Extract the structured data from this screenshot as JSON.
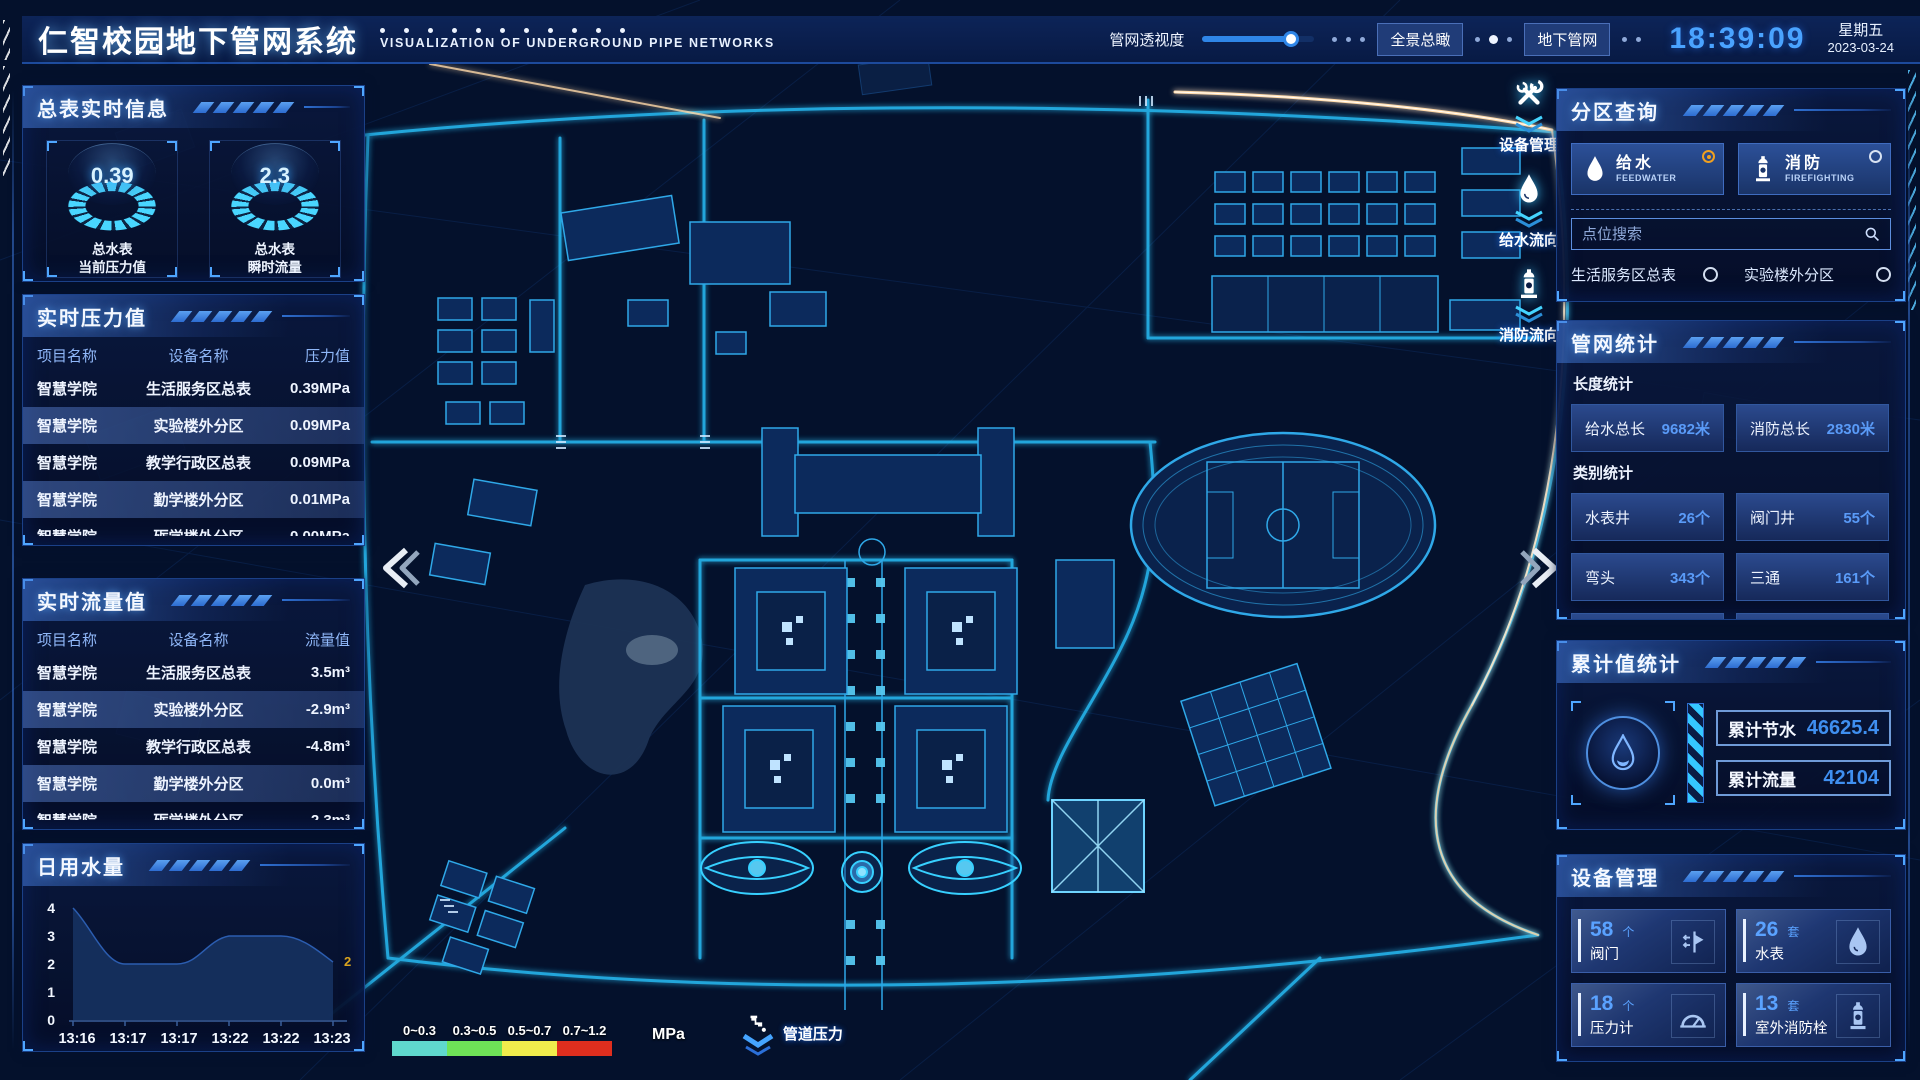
{
  "header": {
    "title": "仁智校园地下管网系统",
    "subtitle": "VISUALIZATION OF UNDERGROUND PIPE NETWORKS",
    "opacity_label": "管网透视度",
    "btn_overview": "全景总瞰",
    "btn_underground": "地下管网",
    "clock": "18:39:09",
    "weekday": "星期五",
    "date": "2023-03-24"
  },
  "meter_info": {
    "title": "总表实时信息",
    "gauges": [
      {
        "value": "0.39",
        "label1": "总水表",
        "label2": "当前压力值"
      },
      {
        "value": "2.3",
        "label1": "总水表",
        "label2": "瞬时流量"
      }
    ]
  },
  "pressure": {
    "title": "实时压力值",
    "headers": [
      "项目名称",
      "设备名称",
      "压力值"
    ],
    "rows": [
      {
        "project": "智慧学院",
        "device": "生活服务区总表",
        "value": "0.39MPa"
      },
      {
        "project": "智慧学院",
        "device": "实验楼外分区",
        "value": "0.09MPa"
      },
      {
        "project": "智慧学院",
        "device": "教学行政区总表",
        "value": "0.09MPa"
      },
      {
        "project": "智慧学院",
        "device": "勤学楼外分区",
        "value": "0.01MPa"
      },
      {
        "project": "智慧学院",
        "device": "砺学楼外分区",
        "value": "0.00MPa"
      }
    ]
  },
  "flow": {
    "title": "实时流量值",
    "headers": [
      "项目名称",
      "设备名称",
      "流量值"
    ],
    "rows": [
      {
        "project": "智慧学院",
        "device": "生活服务区总表",
        "value": "3.5m³"
      },
      {
        "project": "智慧学院",
        "device": "实验楼外分区",
        "value": "-2.9m³"
      },
      {
        "project": "智慧学院",
        "device": "教学行政区总表",
        "value": "-4.8m³"
      },
      {
        "project": "智慧学院",
        "device": "勤学楼外分区",
        "value": "0.0m³"
      },
      {
        "project": "智慧学院",
        "device": "砺学楼外分区",
        "value": "2.3m³"
      }
    ]
  },
  "chart_data": {
    "type": "area",
    "title": "日用水量",
    "x": [
      "13:16",
      "13:17",
      "13:17",
      "13:22",
      "13:22",
      "13:23"
    ],
    "values": [
      4,
      2,
      2,
      3,
      3,
      2
    ],
    "end_label": "2",
    "end_label_color": "#d9a41e",
    "yticks": [
      0,
      1,
      2,
      3,
      4
    ],
    "ylim": [
      0,
      4
    ],
    "grid": false,
    "area_color": "#16315f"
  },
  "zone": {
    "title": "分区查询",
    "feedwater": {
      "cn": "给水",
      "en": "FEEDWATER",
      "selected": true
    },
    "firefighting": {
      "cn": "消防",
      "en": "FIREFIGHTING",
      "selected": false
    },
    "search_placeholder": "点位搜索",
    "items": [
      "生活服务区总表",
      "实验楼外分区",
      "教学行政区总表",
      "勤学楼外分区",
      "砺学楼外分区",
      "宿舍区泵房"
    ]
  },
  "network_stats": {
    "title": "管网统计",
    "length_label": "长度统计",
    "category_label": "类别统计",
    "length_stats": [
      {
        "label": "给水总长",
        "value": "9682米"
      },
      {
        "label": "消防总长",
        "value": "2830米"
      }
    ],
    "category_stats": [
      {
        "label": "水表井",
        "value": "26个"
      },
      {
        "label": "阀门井",
        "value": "55个"
      },
      {
        "label": "弯头",
        "value": "343个"
      },
      {
        "label": "三通",
        "value": "161个"
      }
    ]
  },
  "cumulative": {
    "title": "累计值统计",
    "fields": [
      {
        "label": "累计节水",
        "value": "46625.4"
      },
      {
        "label": "累计流量",
        "value": "42104"
      }
    ]
  },
  "devices": {
    "title": "设备管理",
    "cards": [
      {
        "count": "58",
        "unit": "个",
        "name": "阀门"
      },
      {
        "count": "26",
        "unit": "套",
        "name": "水表"
      },
      {
        "count": "18",
        "unit": "个",
        "name": "压力计"
      },
      {
        "count": "13",
        "unit": "套",
        "name": "室外消防栓"
      }
    ]
  },
  "map": {
    "toolbar": [
      {
        "label": "设备管理"
      },
      {
        "label": "给水流向"
      },
      {
        "label": "消防流向"
      }
    ],
    "legend": {
      "ranges": [
        {
          "label": "0~0.3",
          "color": "#5fd8cd"
        },
        {
          "label": "0.3~0.5",
          "color": "#6ee257"
        },
        {
          "label": "0.5~0.7",
          "color": "#f0ec4c"
        },
        {
          "label": "0.7~1.2",
          "color": "#df2e1e"
        }
      ],
      "unit": "MPa",
      "label": "管道压力"
    },
    "accent_road_color": "#ffd9a8",
    "road_color": "#27b7ee"
  }
}
